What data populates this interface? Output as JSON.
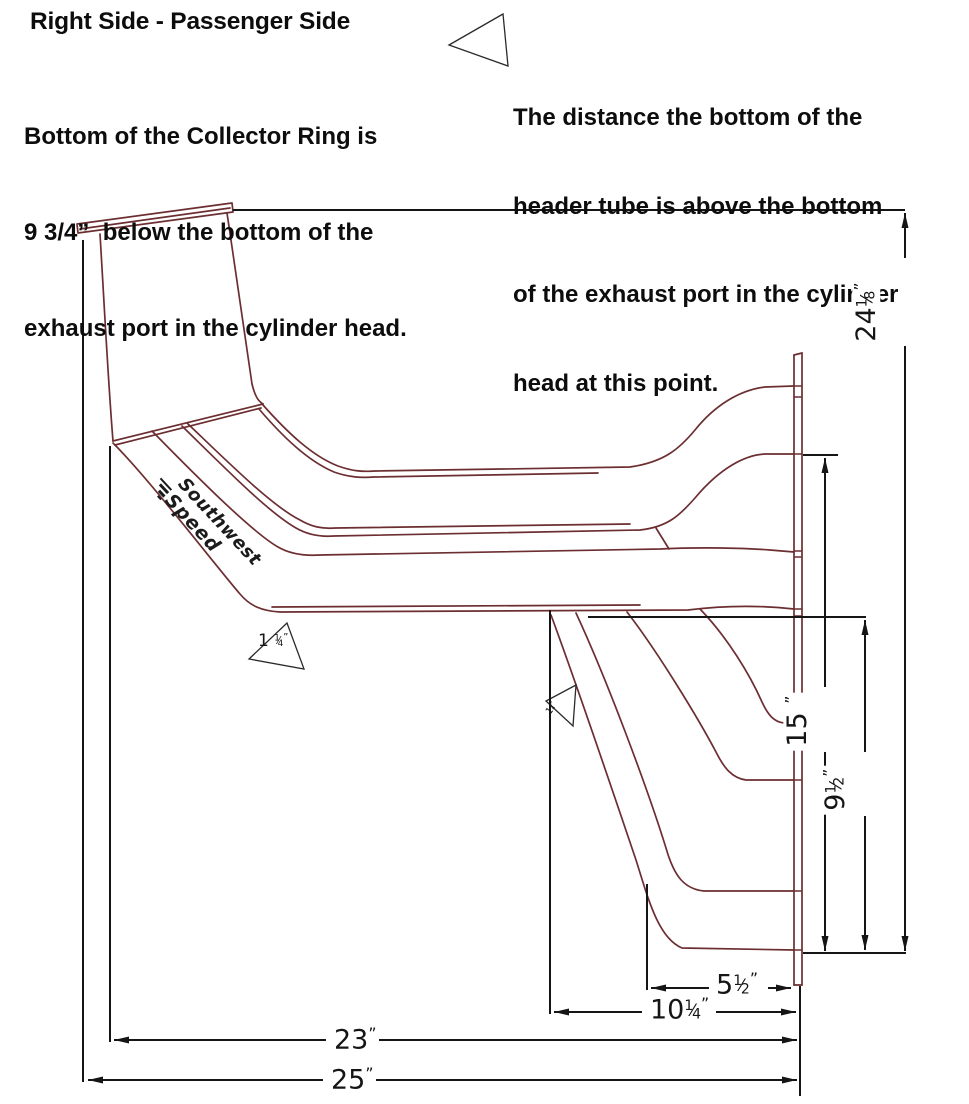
{
  "title": "Right Side - Passenger Side",
  "note_left": {
    "l1": "Bottom of the Collector Ring is",
    "l2": "9 3/4”  below the bottom of the",
    "l3": "exhaust port in the cylinder head."
  },
  "note_right": {
    "l1": "The distance the bottom of the",
    "l2": "header tube is above the bottom",
    "l3": "of the exhaust port in the cylinder",
    "l4": "head at this point."
  },
  "logo": {
    "line1": "Southwest",
    "line2": "Speed"
  },
  "colors": {
    "ink": "#151515",
    "tube_line": "#6c2e31"
  },
  "dims": {
    "overall_height": {
      "w": "24",
      "n": "1",
      "s": "⁄",
      "d": "8",
      "u": "”"
    },
    "port2_height": {
      "w": "15",
      "u": "”"
    },
    "mid_height": {
      "w": "9",
      "n": "1",
      "s": "⁄",
      "d": "2",
      "u": "”"
    },
    "flange_offset": {
      "w": "5",
      "n": "1",
      "s": "⁄",
      "d": "2",
      "u": "”"
    },
    "lower_offset": {
      "w": "10",
      "n": "1",
      "s": "⁄",
      "d": "4",
      "u": "”"
    },
    "collector_setback": {
      "w": "23",
      "u": "”"
    },
    "overall_length": {
      "w": "25",
      "u": "”"
    },
    "tube_callout_big": {
      "w": "1",
      "n": "1",
      "s": "⁄",
      "d": "4",
      "u": "”"
    },
    "tube_callout_small": {
      "w": "1",
      "n": "1",
      "s": "⁄",
      "d": "4",
      "u": "”"
    }
  }
}
